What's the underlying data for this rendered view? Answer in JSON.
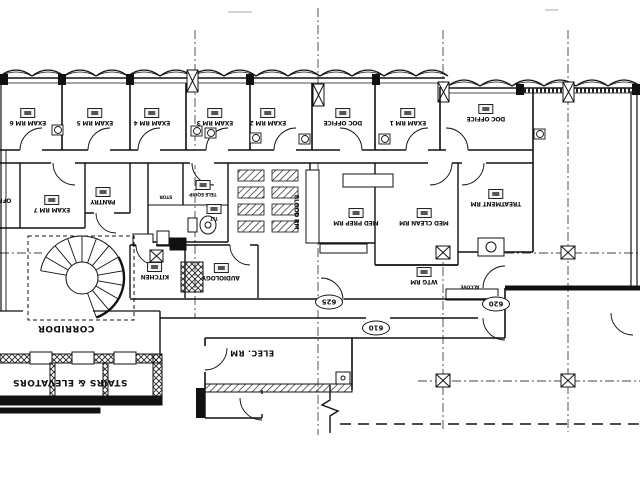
{
  "drawing": {
    "kind": "architectural floor plan (scanned, shown rotated 180 degrees)",
    "background": "#ffffff",
    "line_color": "#1a1a1a"
  },
  "rooms": {
    "exam6": "EXAM RM 6",
    "exam5": "EXAM RM 5",
    "exam4": "EXAM RM 4",
    "exam3": "EXAM RM 3",
    "exam2": "EXAM RM 2",
    "doc_office_a": "DOC OFFICE",
    "exam1": "EXAM RM 1",
    "doc_office_b": "DOC OFFICE",
    "office": "OFFICE",
    "exam7": "EXAM RM 7",
    "pantry": "PANTRY",
    "stor": "STOR",
    "tele_equip": "TELE EQUIP",
    "tlt": "TLT",
    "blood_rm": "BLOOD RM",
    "med_prep": "MED PREP RM",
    "med_clean": "MED CLEAN RM",
    "treatment": "TREATMENT RM",
    "kitchen": "KITCHEN",
    "audiology": "AUDIOLOGY",
    "wtg_rm": "WTG RM",
    "alcove": "ALCOVE"
  },
  "areas": {
    "corridor": "CORRIDOR",
    "stairs_elevators": "STAIRS & ELEVATORS",
    "elec_rm": "ELEC. RM"
  },
  "door_numbers": {
    "n625": "625",
    "n620": "620",
    "n610": "610"
  }
}
